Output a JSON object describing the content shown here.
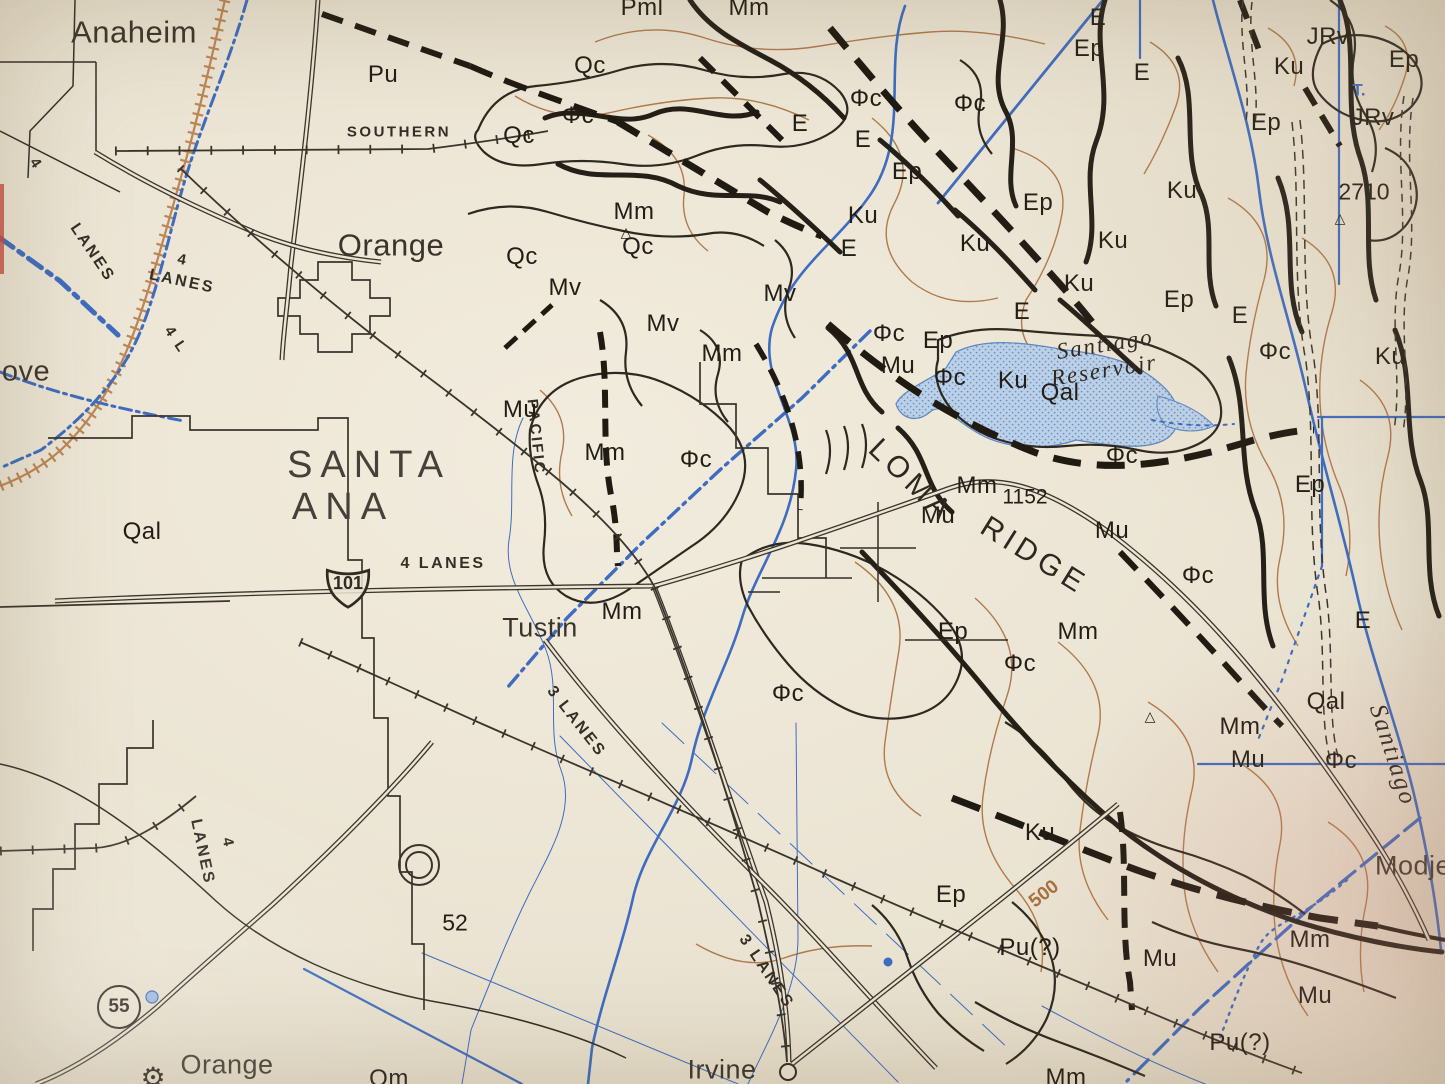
{
  "map": {
    "description": "Photographed paper geologic/topographic map of the Santa Ana – Orange – Tustin – Irvine area with Loma Ridge and Santiago Reservoir",
    "colors": {
      "paper": "#eae3d2",
      "ink": "#221d15",
      "water_blue": "#3e6cc0",
      "contour_brown": "#b07a4c",
      "railroad_orange": "#bc8656",
      "reservoir_fill": "#bcd1e8",
      "red_contour": "#c4543c"
    },
    "units_visible": [
      "Qal",
      "Qm",
      "Qc",
      "Pml",
      "Pu",
      "Pu(?)",
      "Mv",
      "Mm",
      "Mu",
      "E",
      "Ep",
      "Ku",
      "JRv",
      "Φc"
    ],
    "shields": {
      "us101": {
        "number": "101"
      },
      "ca55": {
        "number": "55"
      }
    },
    "labels": [
      {
        "t": "Anaheim",
        "x": 134,
        "y": 32,
        "c": "place",
        "s": 31
      },
      {
        "t": "Orange",
        "x": 391,
        "y": 245,
        "c": "place",
        "s": 31
      },
      {
        "t": "SANTA",
        "x": 369,
        "y": 465,
        "c": "place-big"
      },
      {
        "t": "ANA",
        "x": 343,
        "y": 507,
        "c": "place-big"
      },
      {
        "t": "Tustin",
        "x": 540,
        "y": 628,
        "c": "place"
      },
      {
        "t": "Irvine",
        "x": 722,
        "y": 1070,
        "c": "place"
      },
      {
        "t": "Orange",
        "x": 227,
        "y": 1065,
        "c": "place"
      },
      {
        "t": "Modjes",
        "x": 1420,
        "y": 866,
        "c": "place"
      },
      {
        "t": "ove",
        "x": 26,
        "y": 372,
        "c": "place",
        "s": 29
      },
      {
        "t": "SOUTHERN",
        "x": 399,
        "y": 132,
        "c": "road",
        "s": 15
      },
      {
        "t": "PACIFIC",
        "x": 536,
        "y": 437,
        "c": "road",
        "r": 84,
        "s": 15
      },
      {
        "t": "4 LANES",
        "x": 443,
        "y": 564,
        "c": "road"
      },
      {
        "t": "4",
        "x": 36,
        "y": 164,
        "c": "road",
        "r": 56,
        "s": 15
      },
      {
        "t": "LANES",
        "x": 92,
        "y": 253,
        "c": "road",
        "r": 56
      },
      {
        "t": "4",
        "x": 183,
        "y": 260,
        "c": "road",
        "r": 12,
        "s": 15
      },
      {
        "t": "LANES",
        "x": 182,
        "y": 282,
        "c": "road",
        "r": 12
      },
      {
        "t": "4 L",
        "x": 176,
        "y": 340,
        "c": "road",
        "r": 56,
        "s": 15
      },
      {
        "t": "LANES",
        "x": 202,
        "y": 852,
        "c": "road",
        "r": 78
      },
      {
        "t": "4",
        "x": 228,
        "y": 843,
        "c": "road",
        "r": 78,
        "s": 15
      },
      {
        "t": "3 LANES",
        "x": 576,
        "y": 722,
        "c": "road",
        "r": 52
      },
      {
        "t": "3 LANES",
        "x": 766,
        "y": 972,
        "c": "road",
        "r": 56
      },
      {
        "t": "Pml",
        "x": 642,
        "y": 8,
        "c": "unit"
      },
      {
        "t": "Mm",
        "x": 749,
        "y": 8,
        "c": "unit"
      },
      {
        "t": "Qc",
        "x": 590,
        "y": 66,
        "c": "unit"
      },
      {
        "t": "Pu",
        "x": 383,
        "y": 75,
        "c": "unit"
      },
      {
        "t": "Φc",
        "x": 578,
        "y": 116,
        "c": "unit"
      },
      {
        "t": "Qc",
        "x": 519,
        "y": 136,
        "c": "unit"
      },
      {
        "t": "Φc",
        "x": 866,
        "y": 99,
        "c": "unit"
      },
      {
        "t": "Φc",
        "x": 970,
        "y": 104,
        "c": "unit"
      },
      {
        "t": "E",
        "x": 800,
        "y": 124,
        "c": "unit"
      },
      {
        "t": "E",
        "x": 863,
        "y": 140,
        "c": "unit"
      },
      {
        "t": "Ep",
        "x": 907,
        "y": 172,
        "c": "unit"
      },
      {
        "t": "Ku",
        "x": 863,
        "y": 216,
        "c": "unit"
      },
      {
        "t": "E",
        "x": 1098,
        "y": 18,
        "c": "unit"
      },
      {
        "t": "Ep",
        "x": 1089,
        "y": 49,
        "c": "unit"
      },
      {
        "t": "E",
        "x": 1142,
        "y": 73,
        "c": "unit"
      },
      {
        "t": "JRv",
        "x": 1328,
        "y": 37,
        "c": "unit"
      },
      {
        "t": "Ku",
        "x": 1289,
        "y": 67,
        "c": "unit"
      },
      {
        "t": "Ep",
        "x": 1404,
        "y": 60,
        "c": "unit"
      },
      {
        "t": "Ep",
        "x": 1266,
        "y": 123,
        "c": "unit"
      },
      {
        "t": "JRv",
        "x": 1373,
        "y": 118,
        "c": "unit"
      },
      {
        "t": "Ku",
        "x": 1182,
        "y": 191,
        "c": "unit"
      },
      {
        "t": "Ep",
        "x": 1038,
        "y": 203,
        "c": "unit"
      },
      {
        "t": "Mm",
        "x": 634,
        "y": 212,
        "c": "unit"
      },
      {
        "t": "Qc",
        "x": 638,
        "y": 247,
        "c": "unit"
      },
      {
        "t": "Qc",
        "x": 522,
        "y": 257,
        "c": "unit"
      },
      {
        "t": "Mv",
        "x": 565,
        "y": 288,
        "c": "unit"
      },
      {
        "t": "Ku",
        "x": 975,
        "y": 244,
        "c": "unit"
      },
      {
        "t": "Ku",
        "x": 1113,
        "y": 241,
        "c": "unit"
      },
      {
        "t": "Ku",
        "x": 1079,
        "y": 284,
        "c": "unit"
      },
      {
        "t": "E",
        "x": 849,
        "y": 249,
        "c": "unit"
      },
      {
        "t": "E",
        "x": 1022,
        "y": 312,
        "c": "unit"
      },
      {
        "t": "Ep",
        "x": 1179,
        "y": 300,
        "c": "unit"
      },
      {
        "t": "E",
        "x": 1240,
        "y": 316,
        "c": "unit"
      },
      {
        "t": "Mv",
        "x": 780,
        "y": 294,
        "c": "unit"
      },
      {
        "t": "Mm",
        "x": 722,
        "y": 354,
        "c": "unit"
      },
      {
        "t": "Φc",
        "x": 889,
        "y": 334,
        "c": "unit"
      },
      {
        "t": "Ep",
        "x": 938,
        "y": 341,
        "c": "unit"
      },
      {
        "t": "Mu",
        "x": 898,
        "y": 366,
        "c": "unit"
      },
      {
        "t": "Φc",
        "x": 950,
        "y": 378,
        "c": "unit"
      },
      {
        "t": "Ku",
        "x": 1013,
        "y": 381,
        "c": "unit"
      },
      {
        "t": "Qal",
        "x": 1060,
        "y": 393,
        "c": "unit"
      },
      {
        "t": "Φc",
        "x": 1275,
        "y": 352,
        "c": "unit"
      },
      {
        "t": "Ku",
        "x": 1390,
        "y": 357,
        "c": "unit"
      },
      {
        "t": "Mv",
        "x": 663,
        "y": 324,
        "c": "unit"
      },
      {
        "t": "Mu",
        "x": 520,
        "y": 410,
        "c": "unit"
      },
      {
        "t": "Mm",
        "x": 605,
        "y": 453,
        "c": "unit"
      },
      {
        "t": "Φc",
        "x": 696,
        "y": 460,
        "c": "unit"
      },
      {
        "t": "Mm",
        "x": 622,
        "y": 612,
        "c": "unit"
      },
      {
        "t": "Qal",
        "x": 142,
        "y": 532,
        "c": "unit"
      },
      {
        "t": "Mm",
        "x": 977,
        "y": 486,
        "c": "unit"
      },
      {
        "t": "Mu",
        "x": 938,
        "y": 516,
        "c": "unit"
      },
      {
        "t": "Mu",
        "x": 1112,
        "y": 531,
        "c": "unit"
      },
      {
        "t": "Φc",
        "x": 1122,
        "y": 456,
        "c": "unit"
      },
      {
        "t": "Φc",
        "x": 1198,
        "y": 576,
        "c": "unit"
      },
      {
        "t": "Ep",
        "x": 1310,
        "y": 485,
        "c": "unit"
      },
      {
        "t": "E",
        "x": 1363,
        "y": 621,
        "c": "unit"
      },
      {
        "t": "Mm",
        "x": 1078,
        "y": 632,
        "c": "unit"
      },
      {
        "t": "Ep",
        "x": 953,
        "y": 632,
        "c": "unit"
      },
      {
        "t": "Φc",
        "x": 1020,
        "y": 664,
        "c": "unit"
      },
      {
        "t": "Φc",
        "x": 788,
        "y": 694,
        "c": "unit"
      },
      {
        "t": "Mm",
        "x": 1240,
        "y": 727,
        "c": "unit"
      },
      {
        "t": "Mu",
        "x": 1248,
        "y": 760,
        "c": "unit"
      },
      {
        "t": "Φc",
        "x": 1341,
        "y": 761,
        "c": "unit"
      },
      {
        "t": "Qal",
        "x": 1326,
        "y": 702,
        "c": "unit"
      },
      {
        "t": "Ku",
        "x": 1040,
        "y": 833,
        "c": "unit"
      },
      {
        "t": "Ep",
        "x": 951,
        "y": 895,
        "c": "unit"
      },
      {
        "t": "Pu(?)",
        "x": 1030,
        "y": 948,
        "c": "unit"
      },
      {
        "t": "Mu",
        "x": 1160,
        "y": 959,
        "c": "unit"
      },
      {
        "t": "Mm",
        "x": 1310,
        "y": 940,
        "c": "unit"
      },
      {
        "t": "Mu",
        "x": 1315,
        "y": 996,
        "c": "unit"
      },
      {
        "t": "Pu(?)",
        "x": 1240,
        "y": 1043,
        "c": "unit"
      },
      {
        "t": "Mm",
        "x": 1066,
        "y": 1078,
        "c": "unit"
      },
      {
        "t": "Qm",
        "x": 389,
        "y": 1079,
        "c": "unit"
      },
      {
        "t": "2710",
        "x": 1364,
        "y": 192,
        "c": "elev"
      },
      {
        "t": "1152",
        "x": 1025,
        "y": 497,
        "c": "elev",
        "s": 21
      },
      {
        "t": "52",
        "x": 455,
        "y": 923,
        "c": "elev"
      },
      {
        "t": "500",
        "x": 1044,
        "y": 894,
        "c": "contour",
        "r": -38
      },
      {
        "t": "T.",
        "x": 1359,
        "y": 90,
        "c": "blue"
      },
      {
        "t": "Santiago",
        "x": 1105,
        "y": 344,
        "c": "water",
        "r": -9
      },
      {
        "t": "Reservoir",
        "x": 1104,
        "y": 370,
        "c": "water",
        "r": -9
      },
      {
        "t": "Santiago",
        "x": 1393,
        "y": 755,
        "c": "water",
        "r": 72,
        "s": 25
      },
      {
        "t": "LOMA",
        "x": 911,
        "y": 481,
        "c": "ridge",
        "r": 44
      },
      {
        "t": "RIDGE",
        "x": 1034,
        "y": 556,
        "c": "ridge",
        "r": 32
      },
      {
        "t": "△",
        "x": 626,
        "y": 232,
        "c": "sym",
        "s": 14
      },
      {
        "t": "△",
        "x": 1340,
        "y": 218,
        "c": "sym",
        "s": 14
      },
      {
        "t": "△",
        "x": 1150,
        "y": 716,
        "c": "sym",
        "s": 14
      },
      {
        "t": "⚙",
        "x": 153,
        "y": 1078,
        "c": "sym",
        "s": 28
      }
    ]
  }
}
